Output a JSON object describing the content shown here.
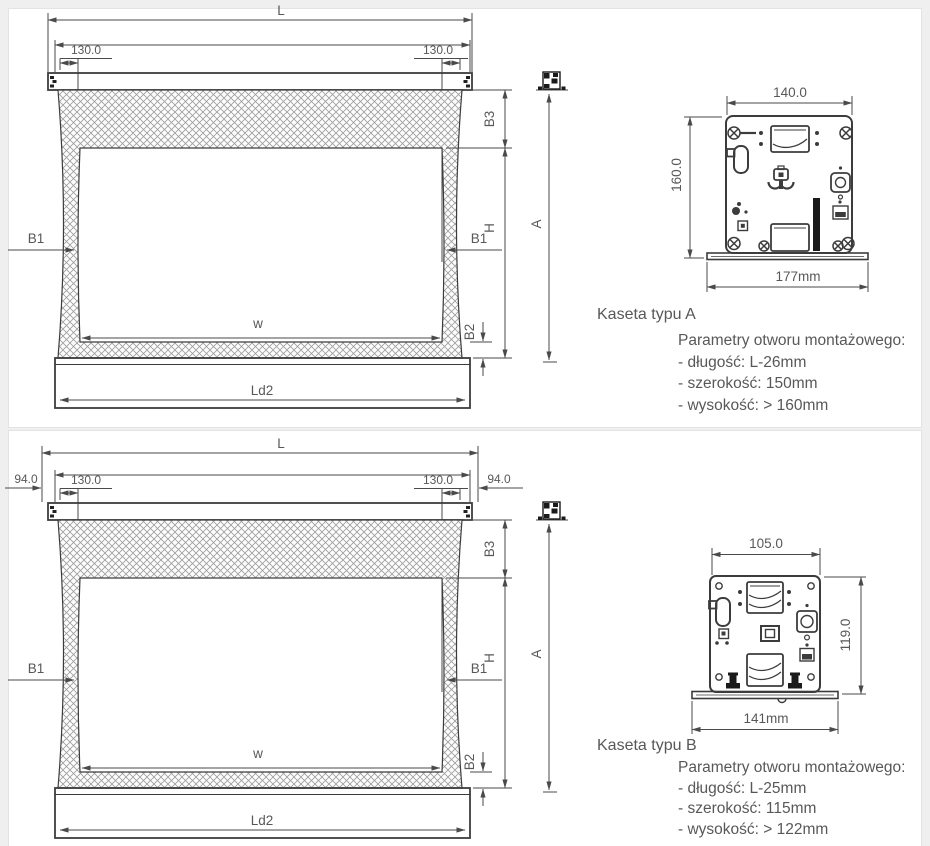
{
  "colors": {
    "page_bg": "#efefef",
    "panel_bg": "#ffffff",
    "drawing_line": "#3c3c3c",
    "dimension_line": "#4a4a4a",
    "text": "#585858"
  },
  "panels": {
    "a": {
      "screen": {
        "L": "L",
        "inner_offset_left": "130.0",
        "inner_offset_right": "130.0",
        "B3": "B3",
        "H": "H",
        "A": "A",
        "B1_left": "B1",
        "B1_right": "B1",
        "B2": "B2",
        "W": "w",
        "Ld2": "Ld2"
      },
      "cassette": {
        "title": "Kaseta typu A",
        "width": "140.0",
        "height": "160.0",
        "base_width": "177mm"
      },
      "params": {
        "title": "Parametry otworu montażowego:",
        "length": "- długość: L-26mm",
        "width": "- szerokość: 150mm",
        "height": "- wysokość: > 160mm"
      }
    },
    "b": {
      "screen": {
        "L": "L",
        "edge_offset_left": "94.0",
        "edge_offset_right": "94.0",
        "inner_offset_left": "130.0",
        "inner_offset_right": "130.0",
        "B3": "B3",
        "H": "H",
        "A": "A",
        "B1_left": "B1",
        "B1_right": "B1",
        "B2": "B2",
        "W": "w",
        "Ld2": "Ld2"
      },
      "cassette": {
        "title": "Kaseta typu B",
        "width": "105.0",
        "height": "119.0",
        "base_width": "141mm"
      },
      "params": {
        "title": "Parametry otworu montażowego:",
        "length": "- długość: L-25mm",
        "width": "- szerokość: 115mm",
        "height": "- wysokość: > 122mm"
      }
    }
  }
}
